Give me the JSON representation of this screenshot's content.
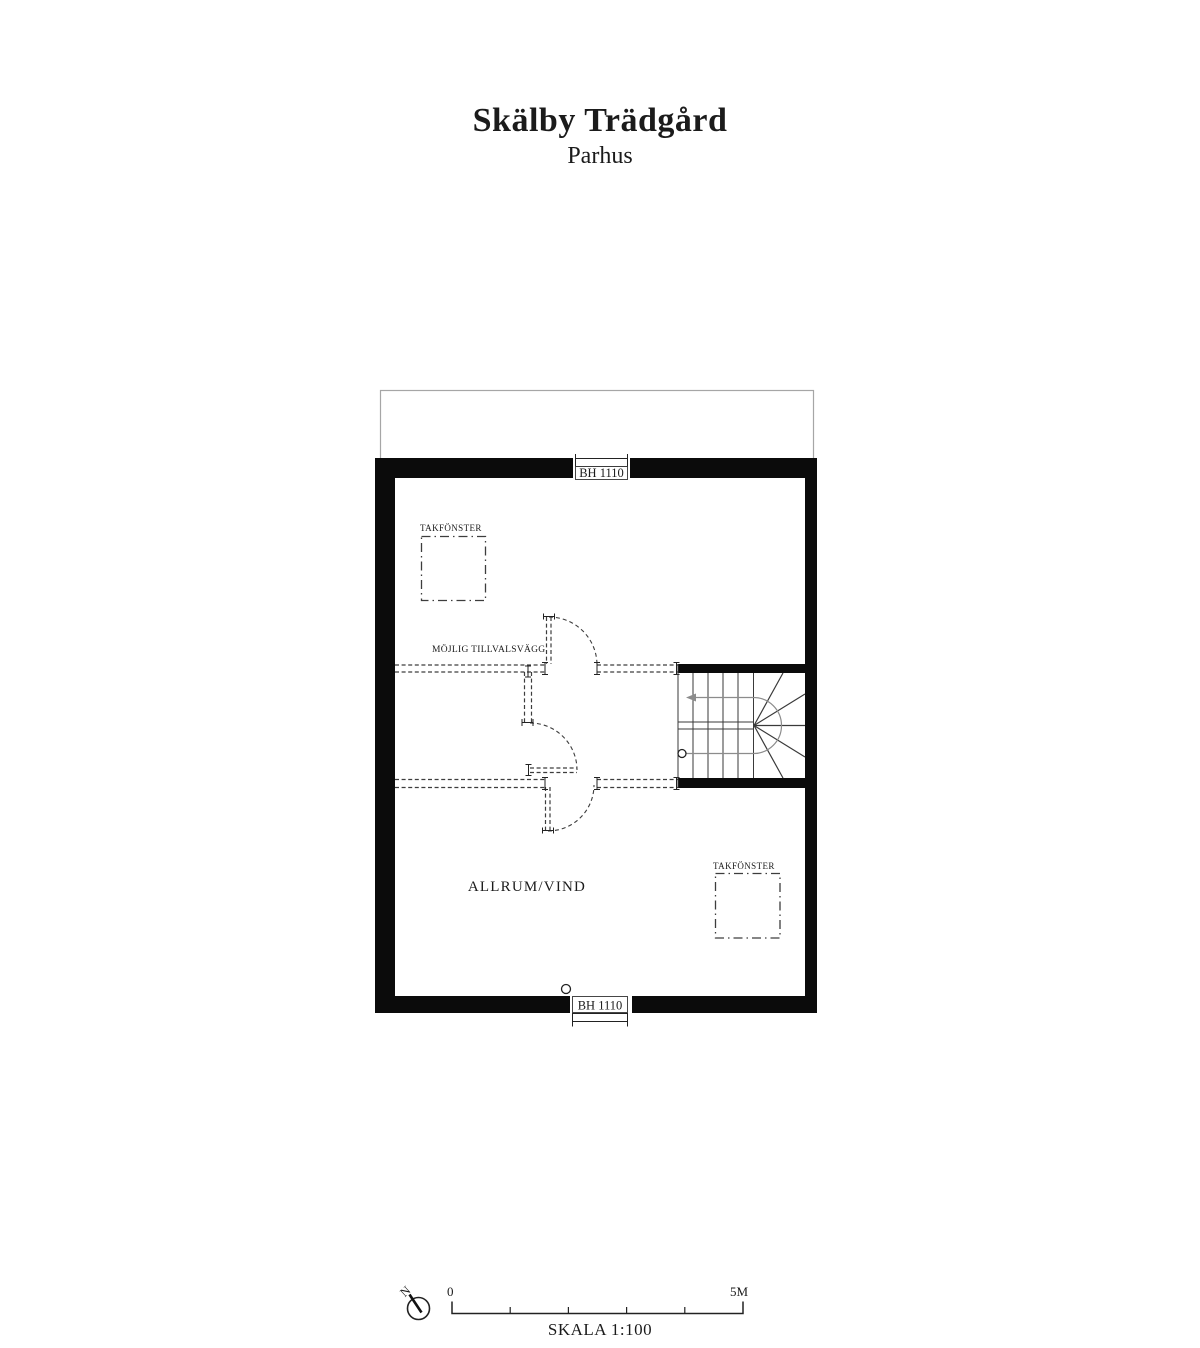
{
  "page": {
    "title": "Skälby Trädgård",
    "subtitle": "Parhus"
  },
  "plan": {
    "room_label": "ALLRUM/VIND",
    "optional_wall_label": "MÖJLIG TILLVALSVÄGG",
    "windows": {
      "top_label": "BH 1110",
      "bottom_label": "BH 1110"
    },
    "skylights": {
      "top_left_label": "TAKFÖNSTER",
      "bottom_right_label": "TAKFÖNSTER"
    }
  },
  "scale_bar": {
    "north_label": "N",
    "origin_label": "0",
    "end_label": "5M",
    "caption": "SKALA 1:100"
  },
  "colors": {
    "wall": "#0b0b0b",
    "thin_outline": "#a6a6a6",
    "dashed": "#3d3d3d",
    "stair": "#3a3a3a",
    "walkline": "#8c8c8c",
    "ink": "#1b1b1b"
  }
}
